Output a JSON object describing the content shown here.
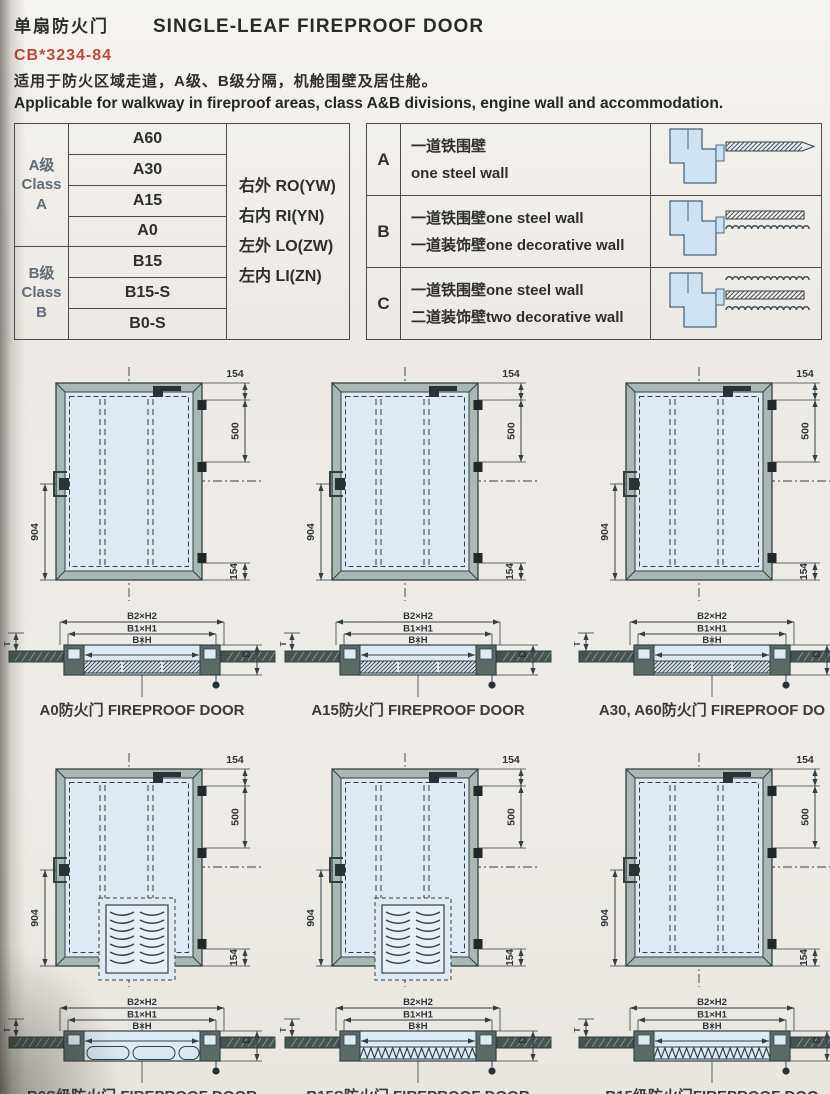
{
  "page": {
    "title_cn": "单扇防火门",
    "title_en": "SINGLE-LEAF FIREPROOF DOOR",
    "standard_no": "CB*3234-84",
    "desc_cn": "适用于防火区域走道，A级、B级分隔，机舱围壁及居住舱。",
    "desc_en": "Applicable for walkway in fireproof areas, class A&B divisions, engine wall and accommodation."
  },
  "class_table": {
    "groups": [
      {
        "lines": [
          "A级",
          "Class",
          "A"
        ],
        "types": [
          "A60",
          "A30",
          "A15",
          "A0"
        ]
      },
      {
        "lines": [
          "B级",
          "Class",
          "B"
        ],
        "types": [
          "B15",
          "B15-S",
          "B0-S"
        ]
      }
    ],
    "orientations": [
      "右外 RO(YW)",
      "右内 RI(YN)",
      "左外 LO(ZW)",
      "左内 LI(ZN)"
    ]
  },
  "wall_table": {
    "rows": [
      {
        "key": "A",
        "lines": [
          "一道铁围壁",
          "one steel wall"
        ],
        "diagram": "one-steel"
      },
      {
        "key": "B",
        "lines": [
          "一道铁围壁one steel wall",
          "一道装饰壁one decorative wall"
        ],
        "diagram": "steel-plus-one"
      },
      {
        "key": "C",
        "lines": [
          "一道铁围壁one steel wall",
          "二道装饰壁two decorative wall"
        ],
        "diagram": "steel-plus-two"
      }
    ]
  },
  "door_dims": {
    "top": "154",
    "middle": "500",
    "height": "904",
    "bottom": "154"
  },
  "section_labels": {
    "outer": "B2×H2",
    "middle": "B1×H1",
    "inner": "B×H",
    "depth": "D",
    "wall": "T"
  },
  "figures": [
    {
      "caption": "A0防火门  FIREPROOF DOOR",
      "louver": false,
      "infill": "hatch"
    },
    {
      "caption": "A15防火门  FIREPROOF DOOR",
      "louver": false,
      "infill": "hatch"
    },
    {
      "caption": "A30, A60防火门  FIREPROOF DO",
      "louver": false,
      "infill": "hatch"
    },
    {
      "caption": "B0S级防火门  FIREPROOF DOOR",
      "louver": true,
      "infill": "pills"
    },
    {
      "caption": "B15S防火门  FIREPROOF DOOR",
      "louver": true,
      "infill": "zigzag"
    },
    {
      "caption": "B15级防火门FIREPROOF DOO",
      "louver": false,
      "infill": "zigzag"
    }
  ],
  "colors": {
    "accent_red": "#c44536",
    "line": "#343f44",
    "door_frame": "#a8b8b2",
    "door_leaf": "#dde9f3",
    "diagram_blue": "#cfe2f1"
  }
}
